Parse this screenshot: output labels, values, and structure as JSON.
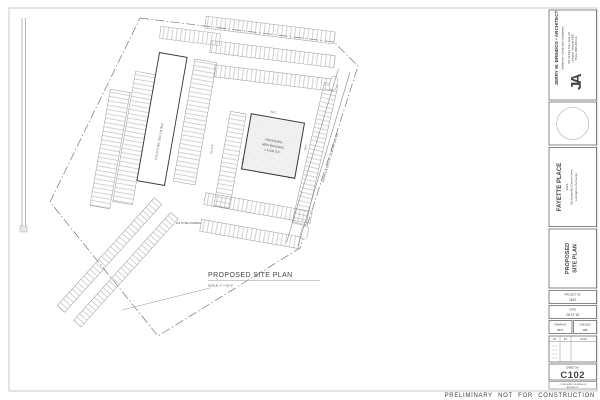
{
  "sheet": {
    "preliminary_note": "PRELIMINARY NOT FOR CONSTRUCTION"
  },
  "drawing": {
    "title": "PROPOSED SITE PLAN",
    "scale_note": "SCALE:  1\" = 30'-0\"",
    "labels": {
      "existing_building": "EXISTING BUILDING",
      "proposed_line1": "PROPOSED",
      "proposed_line2": "NEW BUILDING",
      "proposed_line3": "± 4,500 S.F.",
      "total_parking": "112 TOTAL PARKING",
      "road_name": "NICHOLASVILLE CENTRE DRIVE",
      "dim_aisle": "24.0'",
      "dim_stall": "9.0' TYP.",
      "dim_width": "52.0'",
      "dim_depth": "55.0'"
    }
  },
  "titleblock": {
    "architect": {
      "logo": "JA",
      "name": "JERRY W. BRINDOS • ARCHITECT",
      "tagline": "Architecture • Construction Management",
      "address1": "347 Fontaine Road, Suite 175",
      "address2": "Lexington, Kentucky 40502",
      "phone": "Phone: (859) 266-1131"
    },
    "project": {
      "name": "FAYETTE PLACE",
      "address1": "1901",
      "address2": "Nicholasville Centre Drive",
      "address3": "Lexington, Kentucky"
    },
    "sheet_title": {
      "line1": "PROPOSED",
      "line2": "SITE PLAN"
    },
    "fields": {
      "project_no_label": "PROJECT NO",
      "project_no_value": "1812",
      "date_label": "DATE",
      "date_value": "08 07 18",
      "drawn_label": "DRAWN BY",
      "drawn_value": "BDT",
      "checked_label": "CHECKED",
      "checked_value": "WB"
    },
    "revisions": {
      "no": "NO",
      "by": "BY",
      "date": "DATE"
    },
    "sheet_no_label": "SHEET NO",
    "sheet_no_value": "C102",
    "copyright1": "© 2018 JERRY W. BRINDOS",
    "copyright2": "ARCHITECT"
  }
}
